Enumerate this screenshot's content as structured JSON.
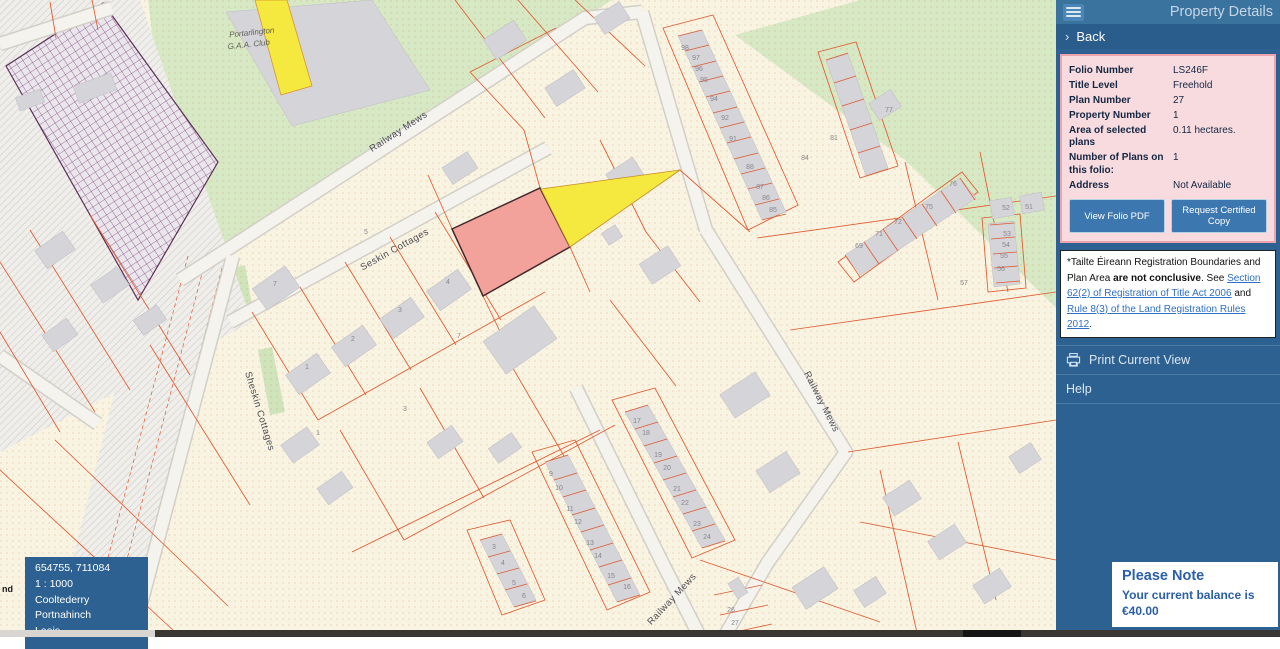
{
  "panel": {
    "header": {
      "title": "Property Details"
    },
    "back": {
      "chevron": "›",
      "label": "Back"
    },
    "details": {
      "rows": [
        {
          "label": "Folio Number",
          "value": "LS246F"
        },
        {
          "label": "Title Level",
          "value": "Freehold"
        },
        {
          "label": "Plan Number",
          "value": "27"
        },
        {
          "label": "Property Number",
          "value": "1"
        },
        {
          "label": "Area of selected plans",
          "value": "0.11 hectares."
        },
        {
          "label": "Number of Plans on this folio:",
          "value": "1"
        },
        {
          "label": "Address",
          "value": "Not Available"
        }
      ],
      "buttons": {
        "view_folio": "View Folio PDF",
        "request_copy": "Request Certified Copy"
      }
    },
    "disclaimer": {
      "part1": "*Tailte Éireann Registration Boundaries and Plan Area ",
      "bold": "are not conclusive",
      "part2": ". See ",
      "link1": "Section 62(2) of Registration of Title Act 2006",
      "joiner": " and ",
      "link2": "Rule 8(3) of the Land Registration Rules 2012",
      "period": "."
    },
    "actions": {
      "print": "Print Current View",
      "help": "Help"
    },
    "note": {
      "title": "Please Note",
      "line1": "Your current balance is",
      "line2": "€40.00"
    }
  },
  "overlay": {
    "coords": "654755, 711084",
    "scale": "1 : 1000",
    "townland": "Cooltederry",
    "area": "Portnahinch",
    "county": "Laois"
  },
  "map": {
    "partial_label": "nd",
    "colors": {
      "selected_parcel": "#f2a19b",
      "laneway_yellow": "#f5e83e",
      "parcel_line": "#e0592e"
    },
    "labels": [
      {
        "t": "Portarlington",
        "transform": "translate(252,35) rotate(-6)",
        "class": "lbl-sm"
      },
      {
        "t": "G.A.A. Club",
        "transform": "translate(249,47) rotate(-6)",
        "class": "lbl-sm"
      },
      {
        "t": "Railway Mews",
        "transform": "translate(400,134) rotate(-33)",
        "class": "lbl"
      },
      {
        "t": "Seskin Cottages",
        "transform": "translate(396,252) rotate(-29)",
        "class": "lbl"
      },
      {
        "t": "Sheskin Cottages",
        "transform": "translate(257,412) rotate(73)",
        "class": "lbl"
      },
      {
        "t": "Railway Mews",
        "transform": "translate(819,403) rotate(63)",
        "class": "lbl"
      },
      {
        "t": "Railway Mews",
        "transform": "translate(674,601) rotate(-47)",
        "class": "lbl"
      }
    ],
    "house_numbers": [
      {
        "t": "98",
        "x": 685,
        "y": 50
      },
      {
        "t": "97",
        "x": 696,
        "y": 60
      },
      {
        "t": "96",
        "x": 699,
        "y": 71
      },
      {
        "t": "95",
        "x": 704,
        "y": 82
      },
      {
        "t": "94",
        "x": 714,
        "y": 101
      },
      {
        "t": "92",
        "x": 725,
        "y": 120
      },
      {
        "t": "91",
        "x": 733,
        "y": 141
      },
      {
        "t": "88",
        "x": 750,
        "y": 169
      },
      {
        "t": "87",
        "x": 760,
        "y": 189
      },
      {
        "t": "86",
        "x": 766,
        "y": 200
      },
      {
        "t": "85",
        "x": 773,
        "y": 212
      },
      {
        "t": "84",
        "x": 805,
        "y": 160
      },
      {
        "t": "81",
        "x": 834,
        "y": 140
      },
      {
        "t": "77",
        "x": 889,
        "y": 112
      },
      {
        "t": "76",
        "x": 953,
        "y": 186
      },
      {
        "t": "75",
        "x": 929,
        "y": 209
      },
      {
        "t": "72",
        "x": 898,
        "y": 224
      },
      {
        "t": "71",
        "x": 879,
        "y": 236
      },
      {
        "t": "69",
        "x": 859,
        "y": 248
      },
      {
        "t": "52",
        "x": 1006,
        "y": 210
      },
      {
        "t": "51",
        "x": 1029,
        "y": 209
      },
      {
        "t": "53",
        "x": 1007,
        "y": 236
      },
      {
        "t": "54",
        "x": 1006,
        "y": 247
      },
      {
        "t": "55",
        "x": 1004,
        "y": 258
      },
      {
        "t": "56",
        "x": 1001,
        "y": 271
      },
      {
        "t": "57",
        "x": 964,
        "y": 285
      },
      {
        "t": "26",
        "x": 731,
        "y": 612
      },
      {
        "t": "27",
        "x": 735,
        "y": 625
      },
      {
        "t": "17",
        "x": 637,
        "y": 423
      },
      {
        "t": "18",
        "x": 646,
        "y": 435
      },
      {
        "t": "19",
        "x": 658,
        "y": 457
      },
      {
        "t": "20",
        "x": 667,
        "y": 470
      },
      {
        "t": "21",
        "x": 677,
        "y": 491
      },
      {
        "t": "22",
        "x": 685,
        "y": 505
      },
      {
        "t": "23",
        "x": 697,
        "y": 526
      },
      {
        "t": "24",
        "x": 707,
        "y": 539
      },
      {
        "t": "9",
        "x": 551,
        "y": 476
      },
      {
        "t": "10",
        "x": 559,
        "y": 490
      },
      {
        "t": "11",
        "x": 570,
        "y": 511
      },
      {
        "t": "12",
        "x": 578,
        "y": 524
      },
      {
        "t": "13",
        "x": 590,
        "y": 545
      },
      {
        "t": "14",
        "x": 598,
        "y": 558
      },
      {
        "t": "15",
        "x": 611,
        "y": 578
      },
      {
        "t": "16",
        "x": 627,
        "y": 589
      },
      {
        "t": "3",
        "x": 494,
        "y": 549
      },
      {
        "t": "4",
        "x": 503,
        "y": 565
      },
      {
        "t": "5",
        "x": 514,
        "y": 585
      },
      {
        "t": "6",
        "x": 524,
        "y": 598
      },
      {
        "t": "7",
        "x": 275,
        "y": 286
      },
      {
        "t": "4",
        "x": 448,
        "y": 284
      },
      {
        "t": "3",
        "x": 400,
        "y": 312
      },
      {
        "t": "2",
        "x": 353,
        "y": 341
      },
      {
        "t": "1",
        "x": 307,
        "y": 369
      },
      {
        "t": "7",
        "x": 459,
        "y": 338
      },
      {
        "t": "3",
        "x": 405,
        "y": 411
      },
      {
        "t": "1",
        "x": 318,
        "y": 435
      },
      {
        "t": "5",
        "x": 366,
        "y": 234
      }
    ]
  }
}
